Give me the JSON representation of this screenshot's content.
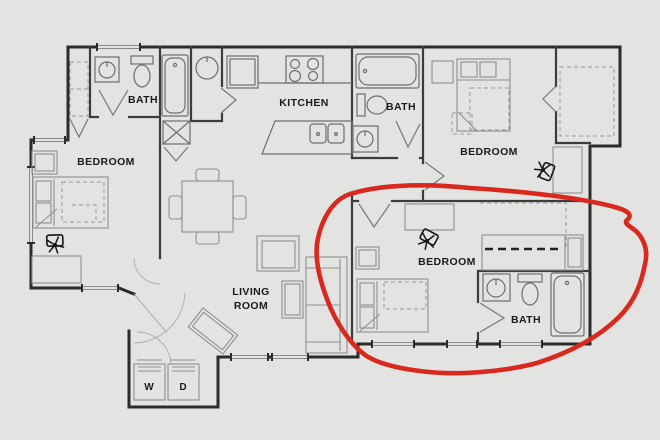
{
  "document": {
    "kind": "apartment floor plan with hand-drawn highlight",
    "background": "#e3e3e2"
  },
  "palette": {
    "wall": "#2b2b2b",
    "interior_wall": "#3c3c3c",
    "fixture_line": "#6e6e6e",
    "furniture_line": "#8f8f8f",
    "label_text": "#1b1b1b",
    "annotation_red": "#d9281e"
  },
  "labels": {
    "bath_top_left": "BATH",
    "bedroom_left": "BEDROOM",
    "kitchen": "KITCHEN",
    "bath_top_middle": "BATH",
    "bedroom_top_right": "BEDROOM",
    "living_room_line1": "LIVING",
    "living_room_line2": "ROOM",
    "bedroom_right": "BEDROOM",
    "bath_right": "BATH",
    "washer": "W",
    "dryer": "D"
  },
  "annotation": {
    "type": "hand-drawn red ellipse",
    "color": "#d9281e",
    "encircles": "right bedroom and bath"
  }
}
